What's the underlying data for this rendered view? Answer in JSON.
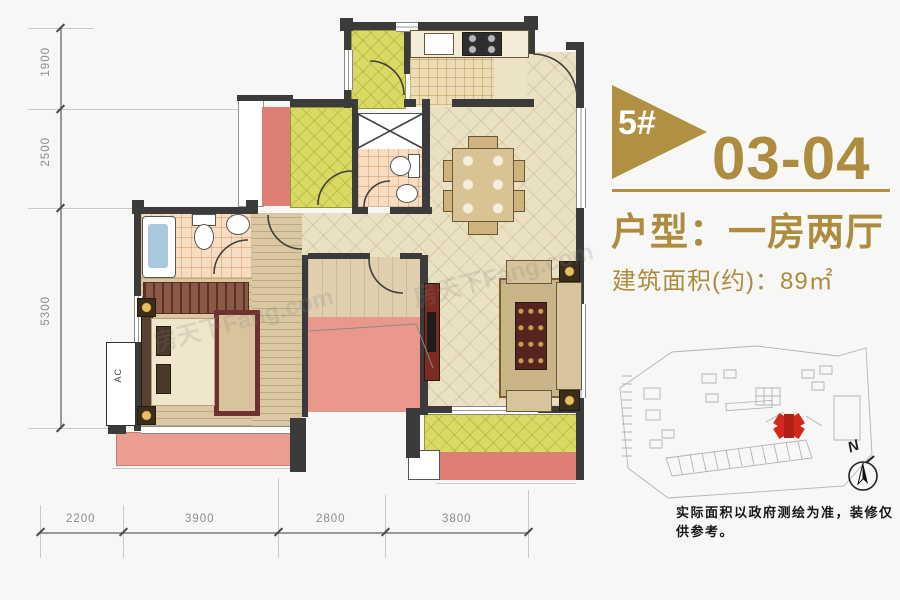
{
  "header": {
    "badge": "5#",
    "unit": "03-04",
    "type": "户型：一房两厅",
    "area": "建筑面积(约)：89㎡"
  },
  "footer": {
    "disclaimer": "实际面积以政府测绘为准，装修仅供参考。"
  },
  "compass": {
    "label": "N"
  },
  "plan": {
    "ac_label": "AC",
    "watermark": "房天下Fang.com"
  },
  "dimensions": {
    "left": [
      "1900",
      "2500",
      "5300"
    ],
    "bottom": [
      "2200",
      "3900",
      "2800",
      "3800"
    ]
  },
  "colors": {
    "accent": "#b19044",
    "wall": "#3b3b3b",
    "highlight": "#d2281c"
  }
}
